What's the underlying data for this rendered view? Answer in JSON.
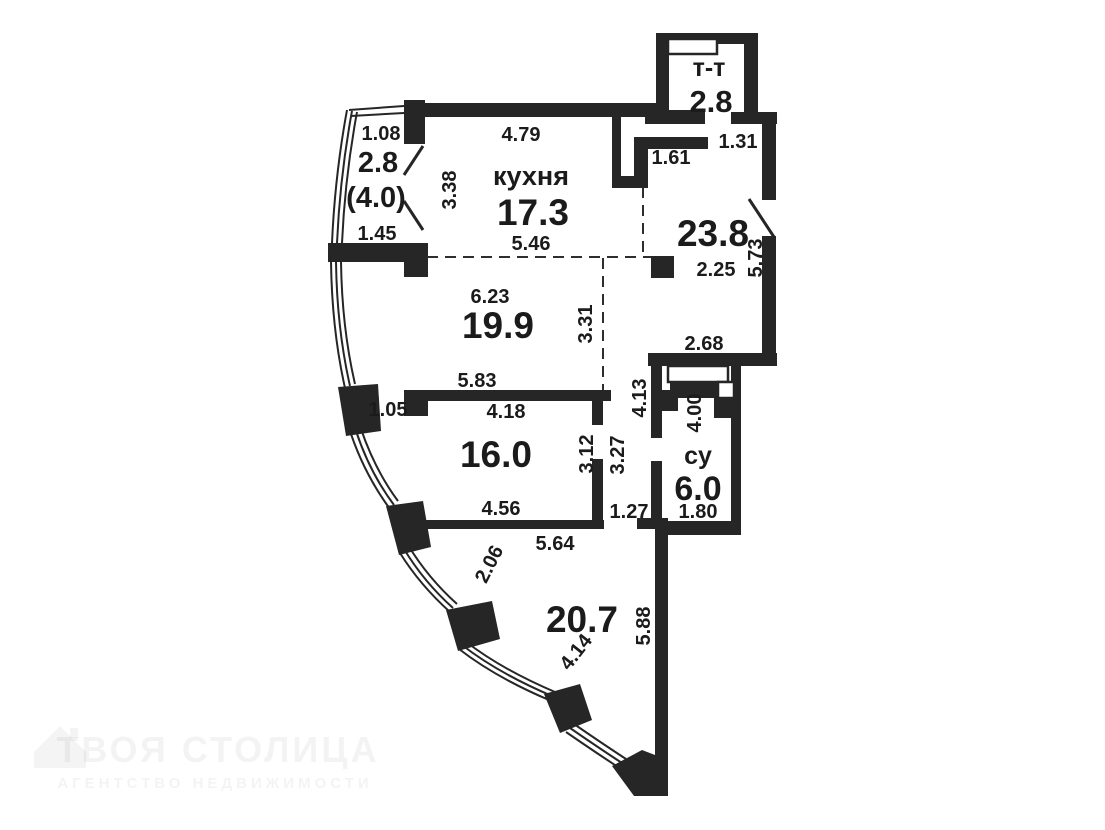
{
  "rooms": {
    "balcony": {
      "area": "2.8",
      "area_alt": "(4.0)",
      "dim_top": "1.08",
      "dim_bottom": "1.45"
    },
    "kitchen": {
      "name": "кухня",
      "area": "17.3",
      "dim_top": "4.79",
      "dim_left": "3.38",
      "dim_bottom": "5.46"
    },
    "vent": {
      "name": "т-т",
      "area": "2.8",
      "dim_below_left": "1.61",
      "dim_below_right": "1.31"
    },
    "hall": {
      "area": "23.8",
      "dim_width": "2.25",
      "dim_right": "5.73",
      "dim_bottom": "2.68"
    },
    "living": {
      "area": "19.9",
      "dim_top": "6.23",
      "dim_right": "3.31",
      "dim_bottom": "5.83"
    },
    "bedroom": {
      "area": "16.0",
      "dim_top_small": "1.05",
      "dim_top": "4.18",
      "dim_right": "3.12",
      "dim_bottom": "4.56"
    },
    "corridor": {
      "dim_inner": "3.27",
      "dim_outer": "4.13",
      "dim_door": "1.27"
    },
    "bath": {
      "name": "су",
      "area": "6.0",
      "dim_left": "4.00",
      "dim_bottom": "1.80"
    },
    "big_room": {
      "area": "20.7",
      "dim_top": "5.64",
      "dim_curve_upper": "2.06",
      "dim_curve_lower": "4.14",
      "dim_right": "5.88"
    }
  },
  "watermark": {
    "title": "ТВОЯ СТОЛИЦА",
    "subtitle": "АГЕНТСТВО НЕДВИЖИМОСТИ"
  },
  "colors": {
    "wall": "#262626",
    "text": "#1b1b1b"
  }
}
